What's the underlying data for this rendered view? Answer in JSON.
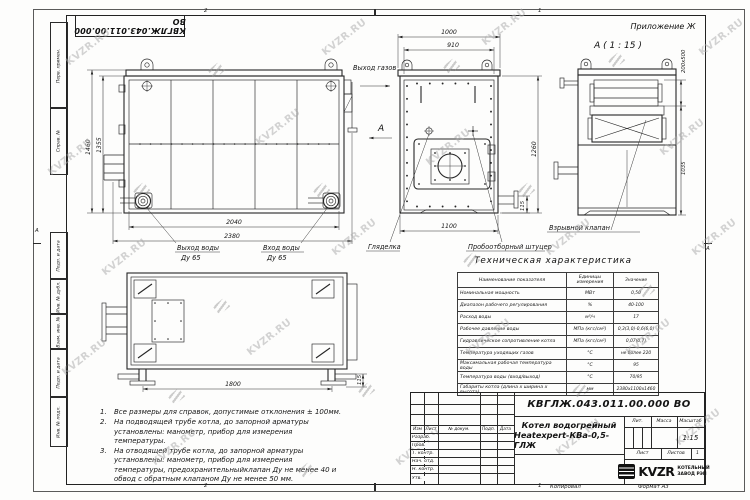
{
  "watermark": {
    "text": "KVZR.RU"
  },
  "frame": {
    "doc_number_top": "КВГЛЖ.043.011.00.000 ВО",
    "side_labels": [
      "Перв. примен.",
      "Справ. №",
      "Подп. и дата",
      "Инв. № дубл.",
      "Взам. инв. №",
      "Подп. и дата",
      "Инв. № подл."
    ],
    "zone_top_left": "2",
    "zone_top_right": "1",
    "zone_bottom_left": "2",
    "zone_bottom_right": "1",
    "zone_left": "А",
    "zone_right": "А",
    "copied_label": "Копировал",
    "format_label": "Формат А3"
  },
  "annotations": {
    "appendix": "Приложение Ж",
    "detail_title": "А ( 1 : 15 )",
    "view_letter": "А",
    "gas_outlet": "Выход газов",
    "water_out_1": "Выход воды",
    "water_out_2": "Ду 65",
    "water_in_1": "Вход воды",
    "water_in_2": "Ду 65",
    "sight_glass": "Гляделка",
    "sampling": "Пробоотборный штуцер",
    "explosion_valve": "Взрывной клапан"
  },
  "dims": {
    "side_h_outer": "1460",
    "side_h_inner": "1355",
    "side_w_inner": "2040",
    "side_w_outer": "2380",
    "front_w_outer": "1000",
    "front_w_inner": "910",
    "front_h": "1260",
    "front_w_bottom": "1100",
    "front_stub": "115",
    "detail_slot": "200х500",
    "detail_h": "1035",
    "top_len": "1800",
    "top_leg": "115"
  },
  "notes": {
    "items": [
      {
        "num": "1.",
        "text": "Все размеры для справок, допустимые отклонения ± 100мм."
      },
      {
        "num": "2.",
        "text": "На подводящей трубе котла, до запорной арматуры установлены: манометр, прибор для измерения температуры."
      },
      {
        "num": "3.",
        "text": "На отводящей трубе котла, до запорной арматуры установлены: манометр, прибор для измерения температуры, предохранительныйклапан Ду не менее 40 и обвод с обратным клапаном Ду не менее 50 мм."
      }
    ]
  },
  "spec_table": {
    "title": "Техническая характеристика",
    "headers": [
      "Наименование показателя",
      "Единицы измерения",
      "Значение"
    ],
    "rows": [
      [
        "Номинальная мощность",
        "МВт",
        "0,50"
      ],
      [
        "Диапазон рабочего регулирования",
        "%",
        "40-100"
      ],
      [
        "Расход воды",
        "м³/ч",
        "17"
      ],
      [
        "Рабочее давление воды",
        "МПа (кгс/см²)",
        "0,3(3,0)-0,6(6,0)"
      ],
      [
        "Гидравлическое сопротивление котла",
        "МПа (кгс/см²)",
        "0,07(0,7)"
      ],
      [
        "Температура уходящих газов",
        "°С",
        "не более 220"
      ],
      [
        "Максимальная рабочая температура воды",
        "°С",
        "95"
      ],
      [
        "Температура воды (вход/выход)",
        "°С",
        "70/95"
      ],
      [
        "Габариты котла (длина х ширина х высота)",
        "мм",
        "2380х1100х1460"
      ]
    ]
  },
  "title_block": {
    "doc_number": "КВГЛЖ.043.011.00.000 ВО",
    "product_line1": "Котел водогрейный",
    "product_line2": "Heatexpert-КВа-0,5-ГЛЖ",
    "col_headers": [
      "Изм",
      "Лист",
      "№ докум.",
      "Подп.",
      "Дата"
    ],
    "row_labels": [
      "Разраб.",
      "Пров.",
      "Т. контр.",
      "Нач. отд.",
      "Н. контр.",
      "Утв."
    ],
    "lit_label": "Лит.",
    "mass_label": "Масса",
    "scale_label": "Масштаб",
    "scale_value": "1:15",
    "sheet_label": "Лист",
    "sheets_label": "Листов",
    "sheets_value": "1",
    "logo_text": "KVZR",
    "company_line1": "КОТЕЛЬНЫЙ",
    "company_line2": "ЗАВОД РЭП"
  }
}
